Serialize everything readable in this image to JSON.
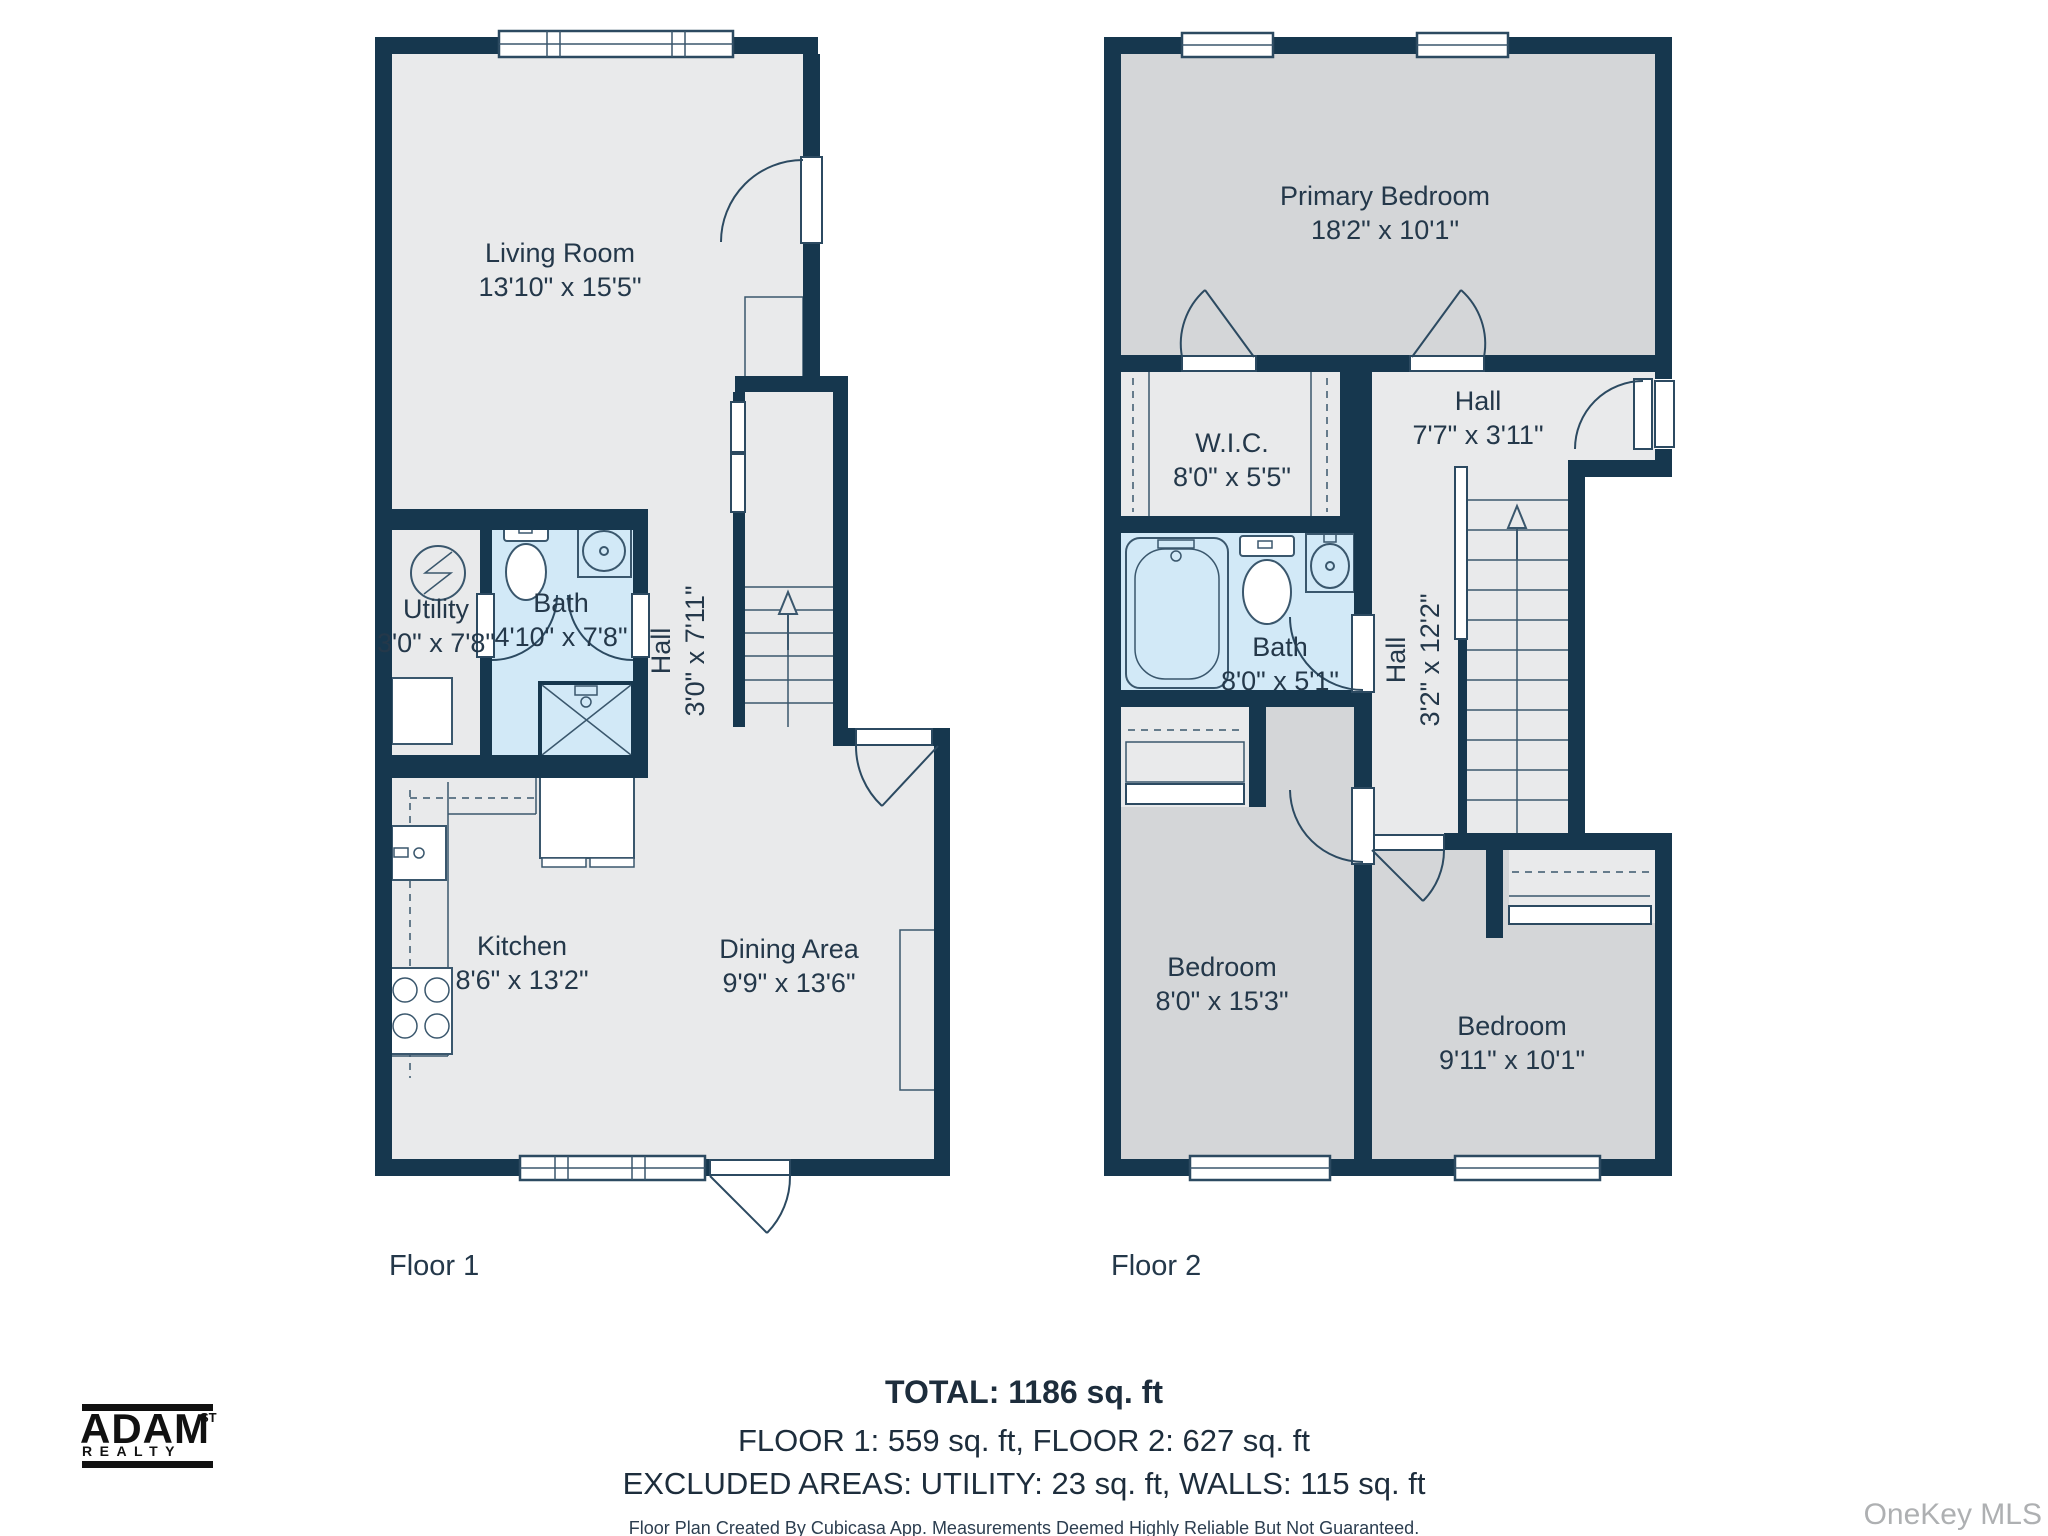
{
  "floor1": {
    "label": "Floor 1",
    "rooms": {
      "living": {
        "name": "Living Room",
        "dims": "13'10\" x 15'5\""
      },
      "utility": {
        "name": "Utility",
        "dims": "3'0\" x 7'8\""
      },
      "bath": {
        "name": "Bath",
        "dims": "4'10\" x 7'8\""
      },
      "hall": {
        "name": "Hall",
        "dims": "3'0\" x 7'11\""
      },
      "kitchen": {
        "name": "Kitchen",
        "dims": "8'6\" x 13'2\""
      },
      "dining": {
        "name": "Dining Area",
        "dims": "9'9\" x 13'6\""
      }
    }
  },
  "floor2": {
    "label": "Floor 2",
    "rooms": {
      "primary": {
        "name": "Primary Bedroom",
        "dims": "18'2\" x 10'1\""
      },
      "wic": {
        "name": "W.I.C.",
        "dims": "8'0\" x 5'5\""
      },
      "hall_upper": {
        "name": "Hall",
        "dims": "7'7\" x 3'11\""
      },
      "bath": {
        "name": "Bath",
        "dims": "8'0\" x 5'1\""
      },
      "hall_lower": {
        "name": "Hall",
        "dims": "3'2\" x 12'2\""
      },
      "bedroom_left": {
        "name": "Bedroom",
        "dims": "8'0\" x 15'3\""
      },
      "bedroom_right": {
        "name": "Bedroom",
        "dims": "9'11\" x 10'1\""
      }
    }
  },
  "summary": {
    "total": "TOTAL: 1186 sq. ft",
    "floors": "FLOOR 1: 559 sq. ft, FLOOR 2: 627 sq. ft",
    "excluded": "EXCLUDED AREAS: UTILITY: 23 sq. ft, WALLS: 115 sq. ft",
    "disclaimer": "Floor Plan Created By Cubicasa App. Measurements Deemed Highly Reliable But Not Guaranteed."
  },
  "branding": {
    "logo_name": "ADAM",
    "logo_superscript": "ST",
    "logo_subtitle": "REALTY",
    "watermark": "OneKey MLS"
  },
  "colors": {
    "wall": "#16374e",
    "room": "#e9eaeb",
    "bedroom": "#d4d6d8",
    "bath": "#d2e9f7",
    "text": "#24384a"
  }
}
